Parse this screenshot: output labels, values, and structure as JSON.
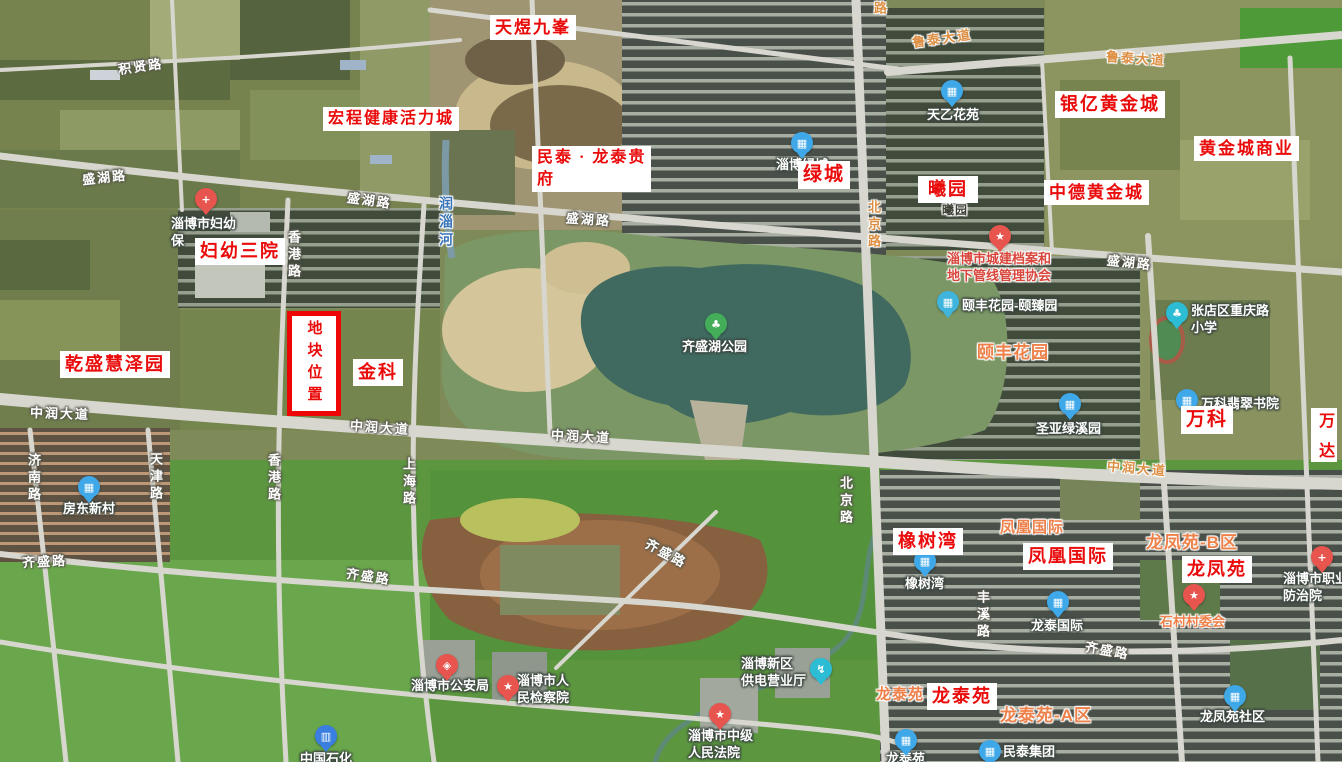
{
  "map": {
    "width": 1342,
    "height": 762,
    "colors": {
      "annotation_red": "#ea0b0b",
      "annotation_bg": "#ffffff",
      "plot_border_red": "#ee0505",
      "road_label_white": "#ffffff",
      "road_label_orange": "#dd8f43",
      "district_orange": "#ee8049",
      "river_blue": "#3a74b8",
      "poi_blue": "#3fa8e8",
      "poi_teal": "#2cbcd4",
      "poi_red": "#e8544e",
      "poi_green": "#43ad5a",
      "poi_gas_blue": "#3a7fe0",
      "lake": "#406a60",
      "field_green": "#5c9740",
      "sand": "#d4c59a"
    },
    "icon_glyphs": {
      "hospital": "+",
      "building": "▦",
      "school": "♣",
      "park": "♣",
      "star": "★",
      "emblem": "★",
      "police": "◈",
      "power": "↯",
      "gas": "▥"
    },
    "plot_marker": {
      "text": "地块位置",
      "x": 287,
      "y": 311,
      "w": 44,
      "h": 95
    },
    "annotations": [
      {
        "id": "tianyu-jiufeng",
        "text": "天煜九峯",
        "x": 490,
        "y": 15,
        "fs": 17
      },
      {
        "id": "hongcheng-huoli-cheng",
        "text": "宏程健康活力城",
        "x": 323,
        "y": 107,
        "fs": 16
      },
      {
        "id": "mintai-longtai-guifu",
        "lines": [
          "民泰 · 龙泰贵",
          "府"
        ],
        "x": 532,
        "y": 146,
        "fs": 16,
        "align": "left",
        "minw": 101
      },
      {
        "id": "fuyou-sanyuan",
        "text": "妇幼三院",
        "x": 195,
        "y": 238,
        "fs": 18
      },
      {
        "id": "yinyi-huangjincheng",
        "text": "银亿黄金城",
        "x": 1055,
        "y": 91,
        "fs": 18
      },
      {
        "id": "huangjincheng-shangye",
        "text": "黄金城商业",
        "x": 1194,
        "y": 136,
        "fs": 17
      },
      {
        "id": "xiyuan",
        "text": "曦园",
        "x": 918,
        "y": 176,
        "fs": 18,
        "minw": 60
      },
      {
        "id": "zhongde-huangjincheng",
        "text": "中德黄金城",
        "x": 1044,
        "y": 180,
        "fs": 17
      },
      {
        "id": "lvcheng",
        "text": "绿城",
        "x": 798,
        "y": 161,
        "fs": 19
      },
      {
        "id": "qiansheng-huizeyuan",
        "text": "乾盛慧泽园",
        "x": 60,
        "y": 351,
        "fs": 18
      },
      {
        "id": "jinke",
        "text": "金科",
        "x": 353,
        "y": 359,
        "fs": 18
      },
      {
        "id": "wanke",
        "text": "万科",
        "x": 1181,
        "y": 406,
        "fs": 19
      },
      {
        "id": "wanda",
        "text": "万达",
        "x": 1311,
        "y": 408,
        "fs": 16,
        "vertical": true,
        "h": 54
      },
      {
        "id": "xiangshuwan",
        "text": "橡树湾",
        "x": 893,
        "y": 528,
        "fs": 18
      },
      {
        "id": "fenghuang-guoji",
        "text": "凤凰国际",
        "x": 1023,
        "y": 543,
        "fs": 18
      },
      {
        "id": "longfengyuan",
        "text": "龙凤苑",
        "x": 1182,
        "y": 556,
        "fs": 18
      },
      {
        "id": "longtaiyuan",
        "text": "龙泰苑",
        "x": 927,
        "y": 683,
        "fs": 18
      }
    ],
    "district_labels": [
      {
        "name": "yifeng-huayuan",
        "text": "颐丰花园",
        "x": 977,
        "y": 338,
        "fs": 17
      },
      {
        "name": "fenghuang-guoji",
        "text": "凤凰国际",
        "x": 1000,
        "y": 516,
        "fs": 15
      },
      {
        "name": "longfengyuan-b",
        "text": "龙凤苑-B区",
        "x": 1146,
        "y": 528,
        "fs": 17
      },
      {
        "name": "longtaiyuan",
        "text": "龙泰苑",
        "x": 876,
        "y": 683,
        "fs": 15
      },
      {
        "name": "longtaiyuan-a",
        "text": "龙泰苑-A区",
        "x": 1000,
        "y": 701,
        "fs": 17
      },
      {
        "name": "xiyuan-small",
        "text": "曦园",
        "x": 942,
        "y": 201,
        "fs": 12,
        "dark": true
      }
    ],
    "road_labels": [
      {
        "name": "jixian-lu",
        "text": "积贤路",
        "x": 118,
        "y": 56,
        "rotate": -8
      },
      {
        "name": "shenghu-lu-1",
        "text": "盛湖路",
        "x": 82,
        "y": 167,
        "rotate": -6
      },
      {
        "name": "shenghu-lu-2",
        "text": "盛湖路",
        "x": 347,
        "y": 190,
        "rotate": 8
      },
      {
        "name": "shenghu-lu-3",
        "text": "盛湖路",
        "x": 566,
        "y": 209,
        "rotate": 4
      },
      {
        "name": "shenghu-lu-4",
        "text": "盛湖路",
        "x": 1107,
        "y": 252,
        "rotate": 6
      },
      {
        "name": "zhongrun-dadao-1",
        "text": "中润大道",
        "x": 30,
        "y": 403,
        "rotate": 2
      },
      {
        "name": "zhongrun-dadao-2",
        "text": "中润大道",
        "x": 350,
        "y": 417,
        "rotate": 4
      },
      {
        "name": "zhongrun-dadao-3",
        "text": "中润大道",
        "x": 551,
        "y": 426,
        "rotate": 3
      },
      {
        "name": "zhongrun-dadao-4",
        "text": "中润大道",
        "x": 1107,
        "y": 458,
        "rotate": 5,
        "color": "orange"
      },
      {
        "name": "qisheng-lu-1",
        "text": "齐盛路",
        "x": 22,
        "y": 551,
        "rotate": -3
      },
      {
        "name": "qisheng-lu-2",
        "text": "齐盛路",
        "x": 346,
        "y": 566,
        "rotate": 8
      },
      {
        "name": "qisheng-lu-3",
        "text": "齐盛路",
        "x": 644,
        "y": 543,
        "rotate": 28
      },
      {
        "name": "qisheng-lu-4",
        "text": "齐盛路",
        "x": 1085,
        "y": 640,
        "rotate": 10
      },
      {
        "name": "lutai-dadao-1",
        "text": "鲁泰大道",
        "x": 912,
        "y": 28,
        "rotate": -8,
        "color": "orange"
      },
      {
        "name": "lutai-dadao-2",
        "text": "鲁泰大道",
        "x": 1106,
        "y": 48,
        "rotate": 4,
        "color": "orange"
      },
      {
        "name": "beijing-lu-1",
        "text": "北京路",
        "x": 864,
        "y": 200,
        "vertical": true,
        "color": "orange"
      },
      {
        "name": "beijing-lu-2",
        "text": "北京路",
        "x": 836,
        "y": 476,
        "vertical": true
      },
      {
        "name": "lu-fragment",
        "text": "路",
        "x": 870,
        "y": 1,
        "vertical": true,
        "color": "orange"
      },
      {
        "name": "jinan-lu",
        "text": "济南路",
        "x": 24,
        "y": 453,
        "vertical": true
      },
      {
        "name": "tianjin-lu",
        "text": "天津路",
        "x": 146,
        "y": 452,
        "vertical": true
      },
      {
        "name": "xianggang-lu-1",
        "text": "香港路",
        "x": 284,
        "y": 230,
        "vertical": true
      },
      {
        "name": "xianggang-lu-2",
        "text": "香港路",
        "x": 264,
        "y": 453,
        "vertical": true
      },
      {
        "name": "shanghai-lu",
        "text": "上海路",
        "x": 399,
        "y": 457,
        "vertical": true
      },
      {
        "name": "fengxi-lu",
        "text": "丰溪路",
        "x": 973,
        "y": 590,
        "vertical": true
      },
      {
        "name": "runzi-he",
        "text": "润淄河",
        "x": 436,
        "y": 196,
        "vertical": true,
        "color": "river",
        "fs": 14
      }
    ],
    "pois": [
      {
        "id": "fuyou-baojian-hospital",
        "lines": [
          "淄博市妇幼",
          "保"
        ],
        "tx": 171,
        "ty": 216,
        "icon": {
          "type": "hospital",
          "color": "#e8544e"
        },
        "ix": 206,
        "iy": 199
      },
      {
        "id": "tianyi-huayuan",
        "lines": [
          "天乙花苑"
        ],
        "tx": 927,
        "ty": 107,
        "icon": {
          "type": "building",
          "color": "#3fa8e8"
        },
        "ix": 952,
        "iy": 91
      },
      {
        "id": "zibo-lvcheng",
        "lines": [
          "淄博绿城"
        ],
        "tx": 776,
        "ty": 157,
        "icon": {
          "type": "building",
          "color": "#3fa8e8"
        },
        "ix": 802,
        "iy": 143
      },
      {
        "id": "chengjian-dangan-xiehui",
        "lines": [
          "淄博市城建档案和",
          "地下管线管理协会"
        ],
        "tx": 947,
        "ty": 251,
        "tc": "redtext",
        "icon": {
          "type": "star",
          "color": "#e8544e"
        },
        "ix": 1000,
        "iy": 236
      },
      {
        "id": "yifeng-yizhenyuan",
        "lines": [
          "颐丰花园-颐臻园"
        ],
        "tx": 962,
        "ty": 298,
        "icon": {
          "type": "building",
          "color": "#3fb4dc"
        },
        "ix": 948,
        "iy": 302
      },
      {
        "id": "chongqinglu-xiaoxue",
        "lines": [
          "张店区重庆路",
          "小学"
        ],
        "tx": 1191,
        "ty": 303,
        "icon": {
          "type": "school",
          "color": "#2cbcd4"
        },
        "ix": 1177,
        "iy": 313
      },
      {
        "id": "wanke-feicui-shuyuan",
        "lines": [
          "万科翡翠书院"
        ],
        "tx": 1201,
        "ty": 396,
        "icon": {
          "type": "building",
          "color": "#3fa8e8"
        },
        "ix": 1187,
        "iy": 400
      },
      {
        "id": "shengya-lvxiyuan",
        "lines": [
          "圣亚绿溪园"
        ],
        "tx": 1036,
        "ty": 421,
        "icon": {
          "type": "building",
          "color": "#3fa8e8"
        },
        "ix": 1070,
        "iy": 404
      },
      {
        "id": "qishenghu-gongyuan",
        "lines": [
          "齐盛湖公园"
        ],
        "tx": 682,
        "ty": 339,
        "icon": {
          "type": "park",
          "color": "#43ad5a"
        },
        "ix": 716,
        "iy": 324
      },
      {
        "id": "fangdong-xincun",
        "lines": [
          "房东新村"
        ],
        "tx": 63,
        "ty": 501,
        "icon": {
          "type": "building",
          "color": "#3fa8e8"
        },
        "ix": 89,
        "iy": 487
      },
      {
        "id": "xiangshuwan",
        "lines": [
          "橡树湾"
        ],
        "tx": 905,
        "ty": 576,
        "icon": {
          "type": "building",
          "color": "#3fa8e8"
        },
        "ix": 925,
        "iy": 561
      },
      {
        "id": "longtai-guoji",
        "lines": [
          "龙泰国际"
        ],
        "tx": 1031,
        "ty": 618,
        "icon": {
          "type": "building",
          "color": "#3fa8e8"
        },
        "ix": 1058,
        "iy": 602
      },
      {
        "id": "shicun-cunweihui",
        "lines": [
          "石村村委会"
        ],
        "tx": 1160,
        "ty": 614,
        "tc": "orangetext",
        "icon": {
          "type": "star",
          "color": "#e8544e"
        },
        "ix": 1194,
        "iy": 595
      },
      {
        "id": "zhiye-fangzhiyuan",
        "lines": [
          "淄博市职业",
          "防治院"
        ],
        "tx": 1283,
        "ty": 571,
        "icon": {
          "type": "hospital",
          "color": "#e8544e"
        },
        "ix": 1322,
        "iy": 557
      },
      {
        "id": "zibo-gonganju",
        "lines": [
          "淄博市公安局"
        ],
        "tx": 411,
        "ty": 678,
        "icon": {
          "type": "police",
          "color": "#e8544e"
        },
        "ix": 447,
        "iy": 665
      },
      {
        "id": "renmin-jianchayuan",
        "lines": [
          "淄博市人",
          "民检察院"
        ],
        "tx": 517,
        "ty": 673,
        "icon": {
          "type": "emblem",
          "color": "#e8544e"
        },
        "ix": 508,
        "iy": 686
      },
      {
        "id": "gongdian-yingyeting",
        "lines": [
          "淄博新区",
          "供电营业厅"
        ],
        "tx": 741,
        "ty": 656,
        "icon": {
          "type": "power",
          "color": "#2cbcd4"
        },
        "ix": 821,
        "iy": 669
      },
      {
        "id": "zhongji-renmin-fayuan",
        "lines": [
          "淄博市中级",
          "人民法院"
        ],
        "tx": 688,
        "ty": 728,
        "icon": {
          "type": "emblem",
          "color": "#e8544e"
        },
        "ix": 720,
        "iy": 714
      },
      {
        "id": "longfengyuan-shequ",
        "lines": [
          "龙凤苑社区"
        ],
        "tx": 1200,
        "ty": 709,
        "icon": {
          "type": "building",
          "color": "#3fa8e8"
        },
        "ix": 1235,
        "iy": 696
      },
      {
        "id": "mintai-jituan",
        "lines": [
          "民泰集团"
        ],
        "tx": 1003,
        "ty": 744,
        "icon": {
          "type": "building",
          "color": "#3fa8e8"
        },
        "ix": 990,
        "iy": 751
      },
      {
        "id": "longtaiyuan",
        "lines": [
          "龙泰苑"
        ],
        "tx": 886,
        "ty": 751,
        "icon": {
          "type": "building",
          "color": "#3fa8e8"
        },
        "ix": 906,
        "iy": 740
      },
      {
        "id": "zhongguo-shihua",
        "lines": [
          "中国石化"
        ],
        "tx": 300,
        "ty": 751,
        "icon": {
          "type": "gas",
          "color": "#3a7fe0"
        },
        "ix": 326,
        "iy": 736
      }
    ]
  }
}
